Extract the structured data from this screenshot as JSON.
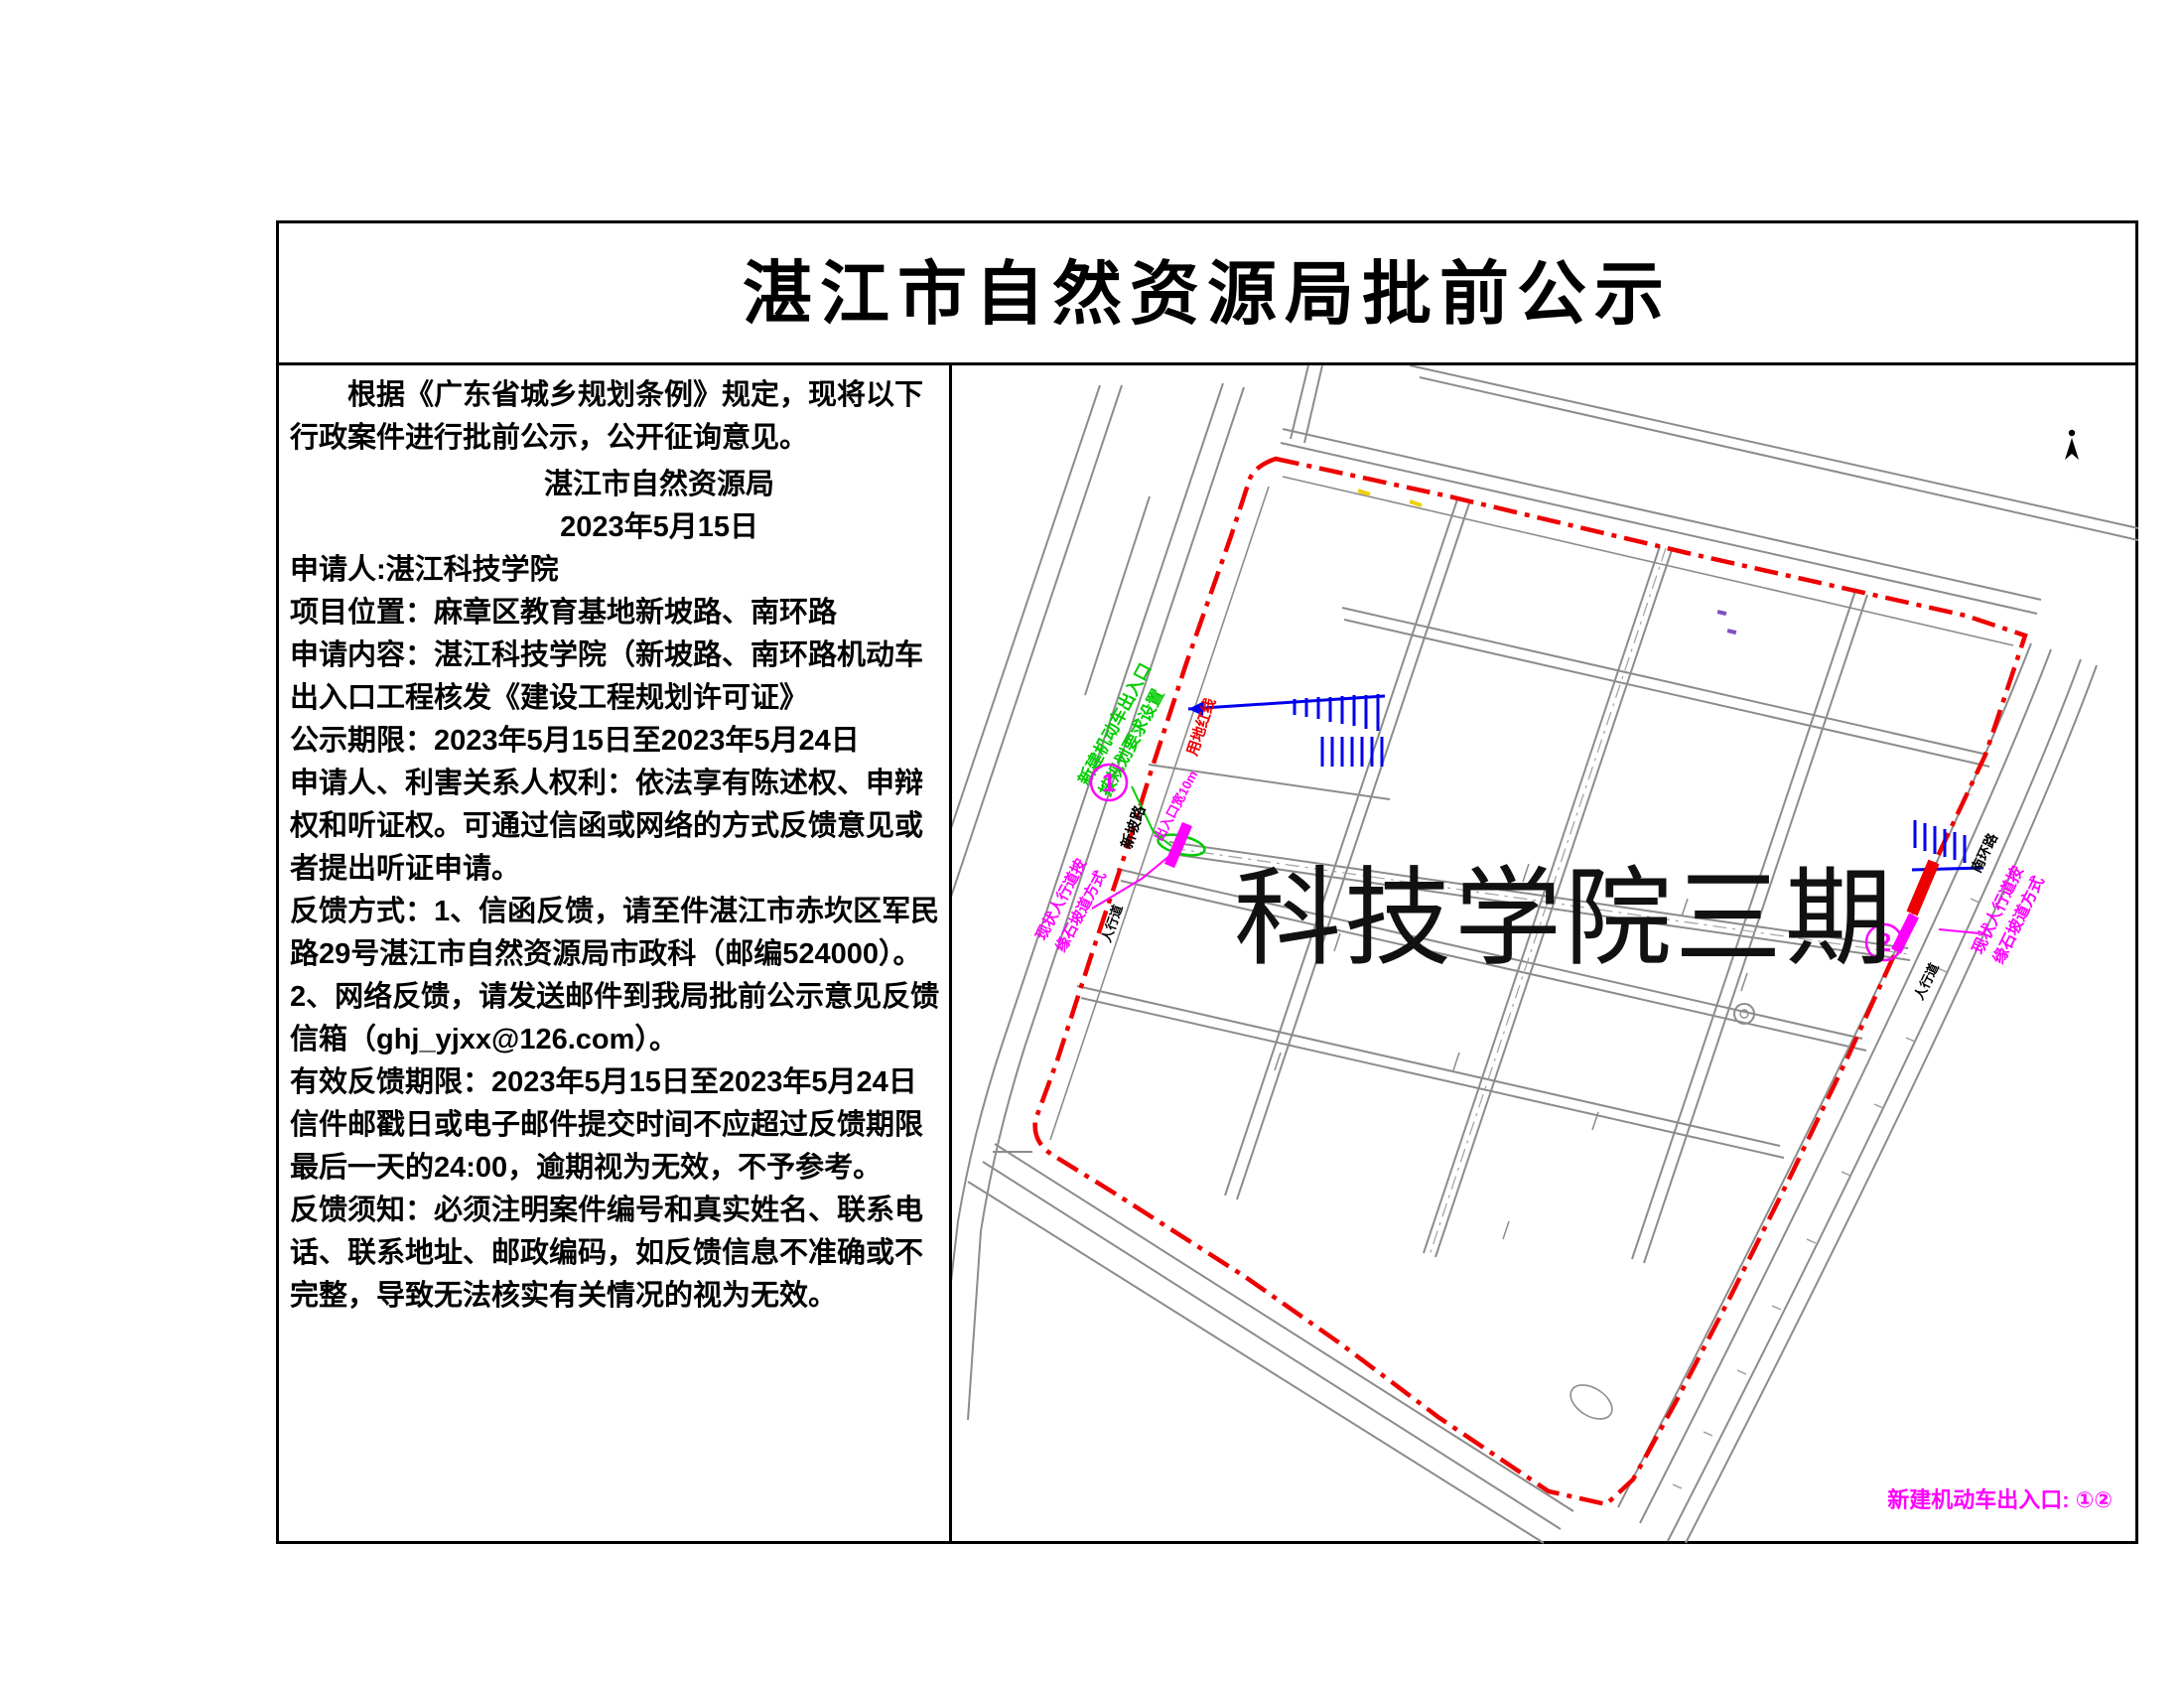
{
  "document": {
    "title": "湛江市自然资源局批前公示",
    "intro": "根据《广东省城乡规划条例》规定，现将以下行政案件进行批前公示，公开征询意见。",
    "signature": {
      "agency": "湛江市自然资源局",
      "date": "2023年5月15日"
    },
    "paragraphs": {
      "applicant": "申请人:湛江科技学院",
      "location": "项目位置：麻章区教育基地新坡路、南环路",
      "content": "申请内容：湛江科技学院（新坡路、南环路机动车出入口工程核发《建设工程规划许可证》",
      "period": "公示期限：2023年5月15日至2023年5月24日",
      "rights": "申请人、利害关系人权利：依法享有陈述权、申辩权和听证权。可通过信函或网络的方式反馈意见或者提出听证申请。",
      "feedback_mail": "反馈方式：1、信函反馈，请至件湛江市赤坎区军民路29号湛江市自然资源局市政科（邮编524000）。",
      "feedback_web": "2、网络反馈，请发送邮件到我局批前公示意见反馈信箱（ghj_yjxx@126.com）。",
      "valid_period": "有效反馈期限：2023年5月15日至2023年5月24日",
      "deadline_note": "信件邮戳日或电子邮件提交时间不应超过反馈期限最后一天的24:00，逾期视为无效，不予参考。",
      "notice": "反馈须知：必须注明案件编号和真实姓名、联系电话、联系地址、邮政编码，如反馈信息不准确或不完整，导致无法核实有关情况的视为无效。"
    }
  },
  "map": {
    "site_name": "科技学院三期",
    "legend": "新建机动车出入口: ①②",
    "entrance1": "1",
    "entrance2": "2",
    "labels": {
      "green1": "新建机动车出入口",
      "green2": "按规划要求设置",
      "red_line": "用地红线",
      "note1_line1": "现状人行道按",
      "note1_line2": "缘石坡道方式",
      "note2_line1": "现状人行道按",
      "note2_line2": "缘石坡道方式",
      "width_note": "出入口宽10m",
      "road_left": "新坡路",
      "road_right": "南环路",
      "sidewalk1": "人行道",
      "sidewalk2": "人行道"
    },
    "colors": {
      "boundary": "#ee0000",
      "annotation": "#ff00ff",
      "new_entrance": "#00cc00",
      "gate_mark": "#0000ee",
      "road": "#8c8c8c"
    }
  }
}
